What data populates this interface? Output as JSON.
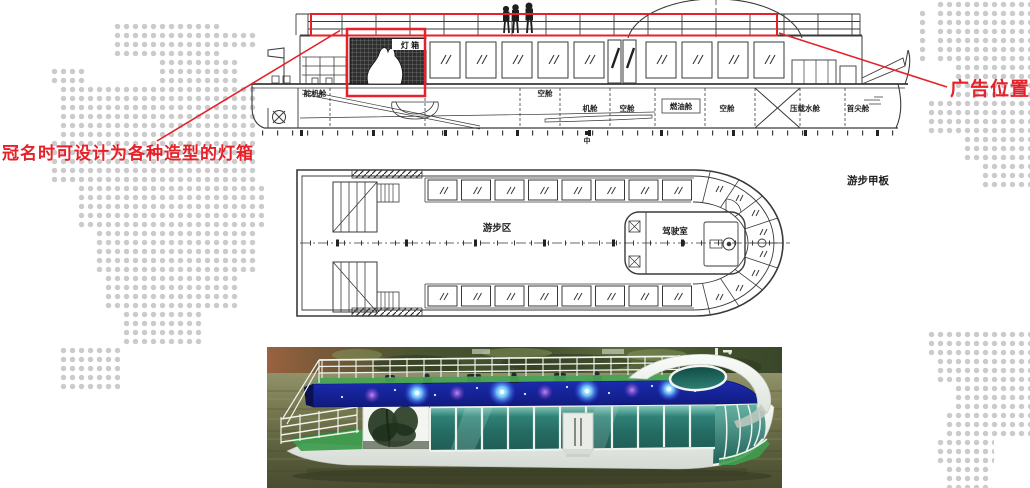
{
  "page": {
    "background": "#ffffff",
    "map_dot_color": "#cbcbcb"
  },
  "annotations": {
    "color": "#e62129",
    "lightbox_note": "冠名时可设计为各种造型的灯箱",
    "ad_position_label": "广告位置"
  },
  "elevation": {
    "lightbox_label": "灯 箱",
    "midship_mark": "中",
    "compartment_labels": [
      "舵机舱",
      "空舱",
      "机舱",
      "空舱",
      "燃油舱",
      "空舱",
      "压载水舱",
      "首尖舱"
    ]
  },
  "deck_plan": {
    "area_label": "游步区",
    "wheelhouse_label": "驾驶室",
    "deck_name": "游步甲板"
  },
  "photo": {
    "led_band_color": "#16209d",
    "glass_color": "#2f8177",
    "deck_color": "#3f9d4f",
    "hull_color": "#f2f4f1",
    "water_color": "#6e704a"
  }
}
